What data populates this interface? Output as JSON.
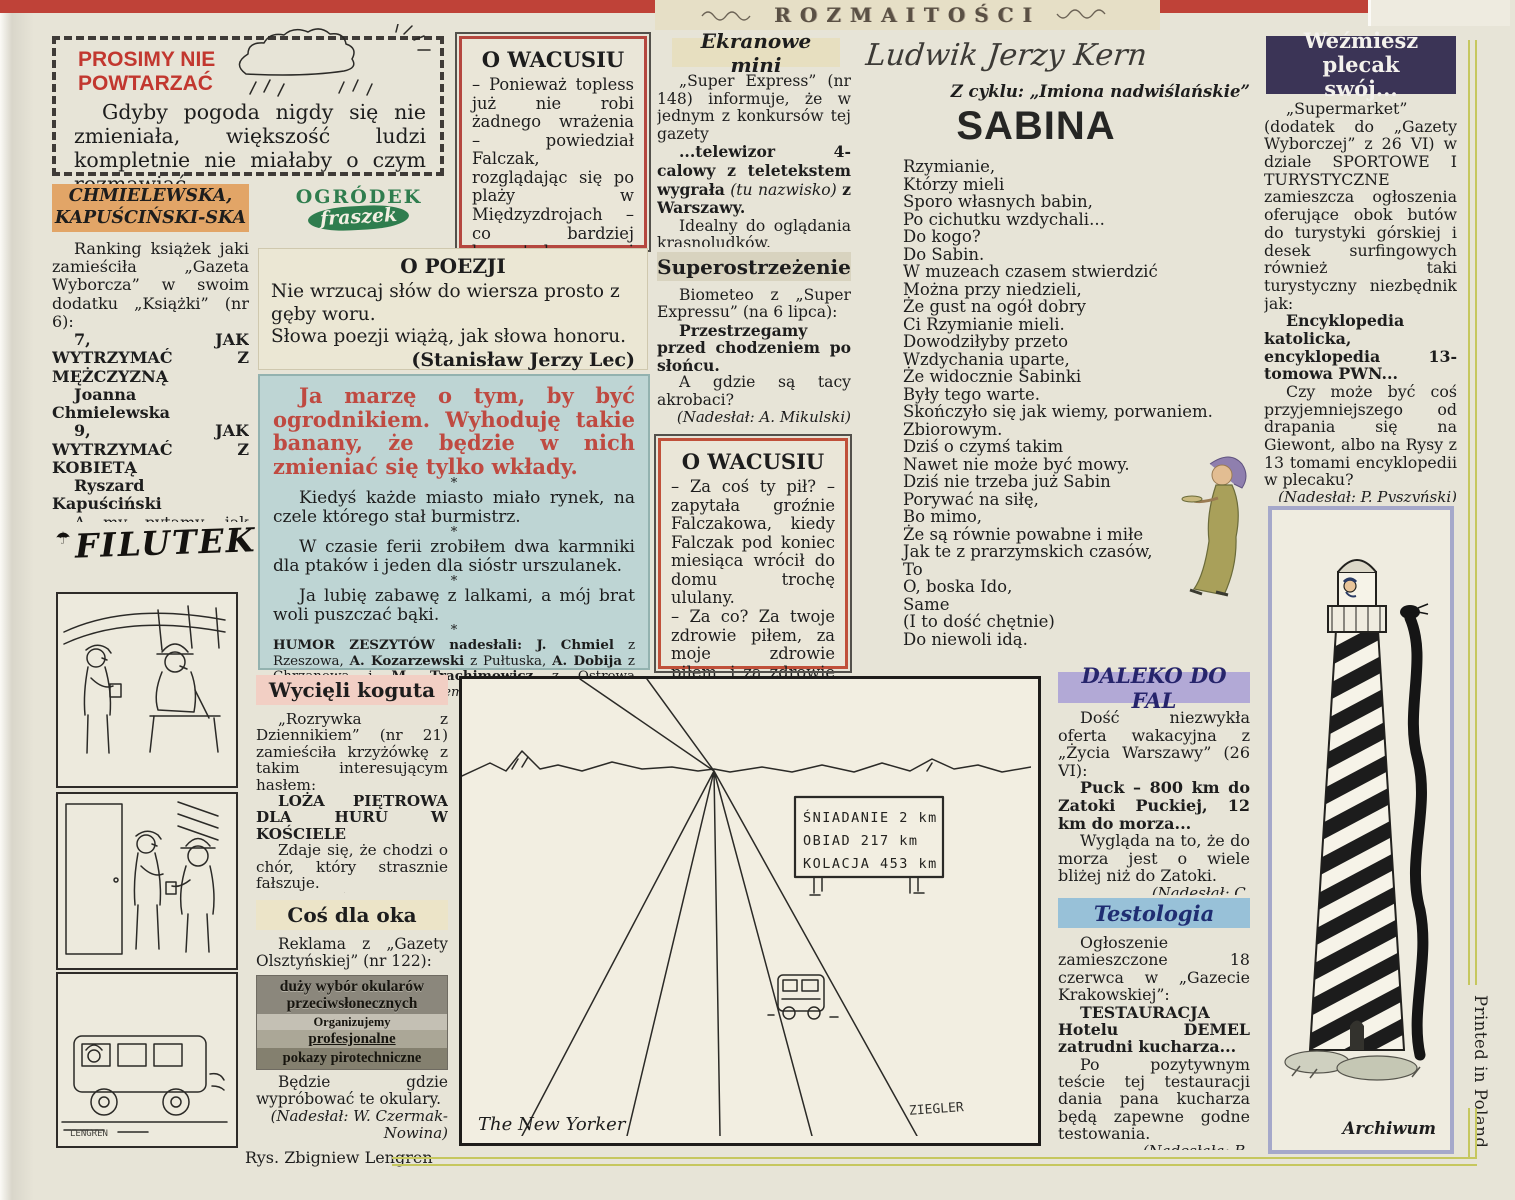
{
  "colors": {
    "masthead_red": "#bf4238",
    "accent_red": "#c2372f",
    "wacusiu_border": "#b5473f",
    "humor_bg": "#bed5d4",
    "humor_lead_red": "#bf4a41",
    "chmielewska_band": "#e2a567",
    "daleko_band": "#b2a9d6",
    "testologia_band": "#98c1d8",
    "wezmiesz_band": "#3b3456",
    "wycieli_band": "#f2cfc4",
    "fraszek_green": "#2f7d4e",
    "olive_line": "#c6c75e"
  },
  "masthead": {
    "title": "ROZMAITOŚCI"
  },
  "prosimy": {
    "line1": "PROSIMY NIE",
    "line2": "POWTARZAĆ",
    "body": "Gdyby pogoda nigdy się nie zmieniała, większość ludzi kompletnie nie miałaby o czym rozmawiać."
  },
  "chmielewska": {
    "heading1": "CHMIELEWSKA,",
    "heading2": "KAPUŚCIŃSKI-SKA",
    "intro": "Ranking książek jaki zamieściła „Gazeta Wyborcza” w swoim dodatku „Książki” (nr 6):",
    "item1": "7, JAK WYTRZYMAĆ Z MĘŻCZYZNĄ",
    "author1": "Joanna Chmielewska",
    "item2": "9, JAK WYTRZYMAĆ Z KOBIETĄ",
    "author2": "Ryszard Kapuściński",
    "outro": "A my pytamy, jak wytrzymać z takim rankingiem?",
    "credit": "(Nadesłał: E. Biela)"
  },
  "filutek": {
    "umbrella": "☂",
    "title": "FILUTEK",
    "signature": "LENGREN",
    "caption": "Rys. Zbigniew Lengren"
  },
  "wacusiu1": {
    "heading": "O WACUSIU",
    "body": "– Ponieważ topless już nie robi żadnego wrażenia – powiedział Falczak, rozglądając się po plaży w Międzyzdrojach – co bardziej bezwstydne i odważne zaczęły nosić staniki."
  },
  "ogrodek": {
    "top": "OGRÓDEK",
    "bottom": "fraszek"
  },
  "poezja": {
    "heading": "O POEZJI",
    "line1": "Nie wrzucaj słów do wiersza prosto z gęby woru.",
    "line2": "Słowa poezji wiążą, jak słowa honoru.",
    "credit": "(Stanisław Jerzy Lec)"
  },
  "humor": {
    "lead": "Ja marzę o tym, by być ogrodnikiem. Wyhoduję takie banany, że będzie w nich zmieniać się tylko wkłady.",
    "star": "*",
    "item1": "Kiedyś każde miasto miało rynek, na czele którego stał burmistrz.",
    "item2": "W czasie ferii zrobiłem dwa karmniki dla ptaków i jeden dla sióstr urszulanek.",
    "item3": "Ja lubię zabawę z lalkami, a mój brat woli puszczać bąki.",
    "footer": {
      "s1": "HUMOR ZESZYTÓW nadesłali: ",
      "s2": "J. Chmiel",
      "s3": " z Rzeszowa, ",
      "s4": "A. Kozarzewski",
      "s5": " z Pułtuska, ",
      "s6": "A. Dobija",
      "s7": " z Chrzanowa i ",
      "s8": "M. Trachimowicz",
      "s9": " z Ostrowa Wielkopolskiego. ",
      "s10": "Dziękujemy."
    }
  },
  "ekranowe": {
    "heading": "Ekranowe mini",
    "p1": "„Super Express” (nr 148) informuje, że w jednym z konkursów tej gazety",
    "p2_bold": "...telewizor 4-calowy z teletekstem wygrała",
    "p2_italic": "(tu nazwisko)",
    "p2_bold2": "z Warszawy.",
    "p3": "Idealny do oglądania krasnoludków.",
    "credit": "(Nadesłał: E. Gąsior)"
  },
  "superostrzezenie": {
    "heading": "Superostrzeżenie",
    "p1": "Biometeo z „Super Expressu” (na 6 lipca):",
    "p2": "Przestrzegamy przed chodzeniem po słońcu.",
    "p3": "A gdzie są tacy akrobaci?",
    "credit": "(Nadesłał: A. Mikulski)"
  },
  "wacusiu2": {
    "heading": "O WACUSIU",
    "p1": "– Za coś ty pił? – zapytała groźnie Falczakowa, kiedy Falczak pod koniec miesiąca wrócił do domu trochę ululany.",
    "p2": "– Za co? Za twoje zdrowie piłem, za moje zdrowie piłem, i za zdrowie naszych dzieci i wnuków też piłem."
  },
  "kern": {
    "author": "Ludwik Jerzy Kern",
    "cycle": "Z cyklu: „Imiona nadwiślańskie”",
    "title": "SABINA",
    "lines": [
      "Rzymianie,",
      "Którzy mieli",
      "Sporo własnych babin,",
      "Po cichutku wzdychali...",
      "Do kogo?",
      "Do Sabin.",
      "W muzeach czasem stwierdzić",
      "Można przy niedzieli,",
      "Że gust na ogół dobry",
      "Ci Rzymianie mieli.",
      "Dowodziłyby przeto",
      "Wzdychania uparte,",
      "Że widocznie Sabinki",
      "Były tego warte.",
      "Skończyło się jak wiemy, porwaniem.",
      "Zbiorowym.",
      "Dziś o czymś takim",
      "Nawet nie może być mowy.",
      "Dziś nie trzeba już Sabin",
      "Porywać na siłę,",
      "Bo mimo,",
      "Że są równie powabne i miłe",
      "Jak te z prarzymskich czasów,",
      "To",
      "O, boska Ido,",
      "Same",
      "(I to dość chętnie)",
      "Do niewoli idą."
    ]
  },
  "cartoon": {
    "sign1": "ŚNIADANIE 2 km",
    "sign2": "OBIAD  217 km",
    "sign3": "KOLACJA 453 km",
    "caption": "The New Yorker",
    "signature": "ZIEGLER"
  },
  "daleko": {
    "heading": "DALEKO DO FAL",
    "p1": "Dość niezwykła oferta wakacyjna z „Życia Warszawy” (26 VI):",
    "p2": "Puck – 800 km do Zatoki Puckiej, 12 km do morza...",
    "p3": "Wygląda na to, że do morza jest o wiele bliżej niż do Zatoki.",
    "credit": "(Nadesłał: C. Kwaśniewski)"
  },
  "testologia": {
    "heading": "Testologia",
    "p1": "Ogłoszenie zamieszczone 18 czerwca w „Gazecie Krakowskiej”:",
    "p2": "TESTAURACJA Hotelu DEMEL zatrudni kucharza...",
    "p3": "Po pozytywnym teście tej testauracji dania pana kucharza będą zapewne godne testowania.",
    "credit": "(Nadesłała: B. Żurakowska)"
  },
  "wezmiesz": {
    "heading1": "Weźmiesz plecak",
    "heading2": "swój...",
    "p1": "„Supermarket” (dodatek do „Gazety Wyborczej” z 26 VI) w dziale SPORTOWE I TURYSTYCZNE zamieszcza ogłoszenia oferujące obok butów do turystyki górskiej i desek surfingowych również taki turystyczny niezbędnik jak:",
    "p2": "Encyklopedia katolicka, encyklopedia 13-tomowa PWN...",
    "p3": "Czy może być coś przyjemniejszego od drapania się na Giewont, albo na Rysy z 13 tomami encyklopedii w plecaku?",
    "credit": "(Nadesłał: P. Pyszyński)"
  },
  "wycieli": {
    "heading": "Wycięli koguta",
    "p1": "„Rozrywka z Dziennikiem” (nr 21) zamieściła krzyżówkę z takim interesującym hasłem:",
    "p2": "LOŻA PIĘTROWA DLA HURU W KOŚCIELE",
    "p3": "Zdaje się, że chodzi o chór, który strasznie fałszuje.",
    "credit": "(Nadesłała: W. Liguzińska)"
  },
  "cos": {
    "heading": "Coś dla oka",
    "p1": "Reklama z „Gazety Olsztyńskiej” (nr 122):",
    "ad1": "duży wybór okularów",
    "ad2": "przeciwsłonecznych",
    "ad3": "Organizujemy",
    "ad4": "profesjonalne",
    "ad5": "pokazy pirotechniczne",
    "p2": "Będzie gdzie wypróbować te okulary.",
    "credit": "(Nadesłał: W. Czermak-Nowina)"
  },
  "archiwum": {
    "caption": "Archiwum"
  },
  "printed": {
    "label": "Printed in Poland"
  }
}
